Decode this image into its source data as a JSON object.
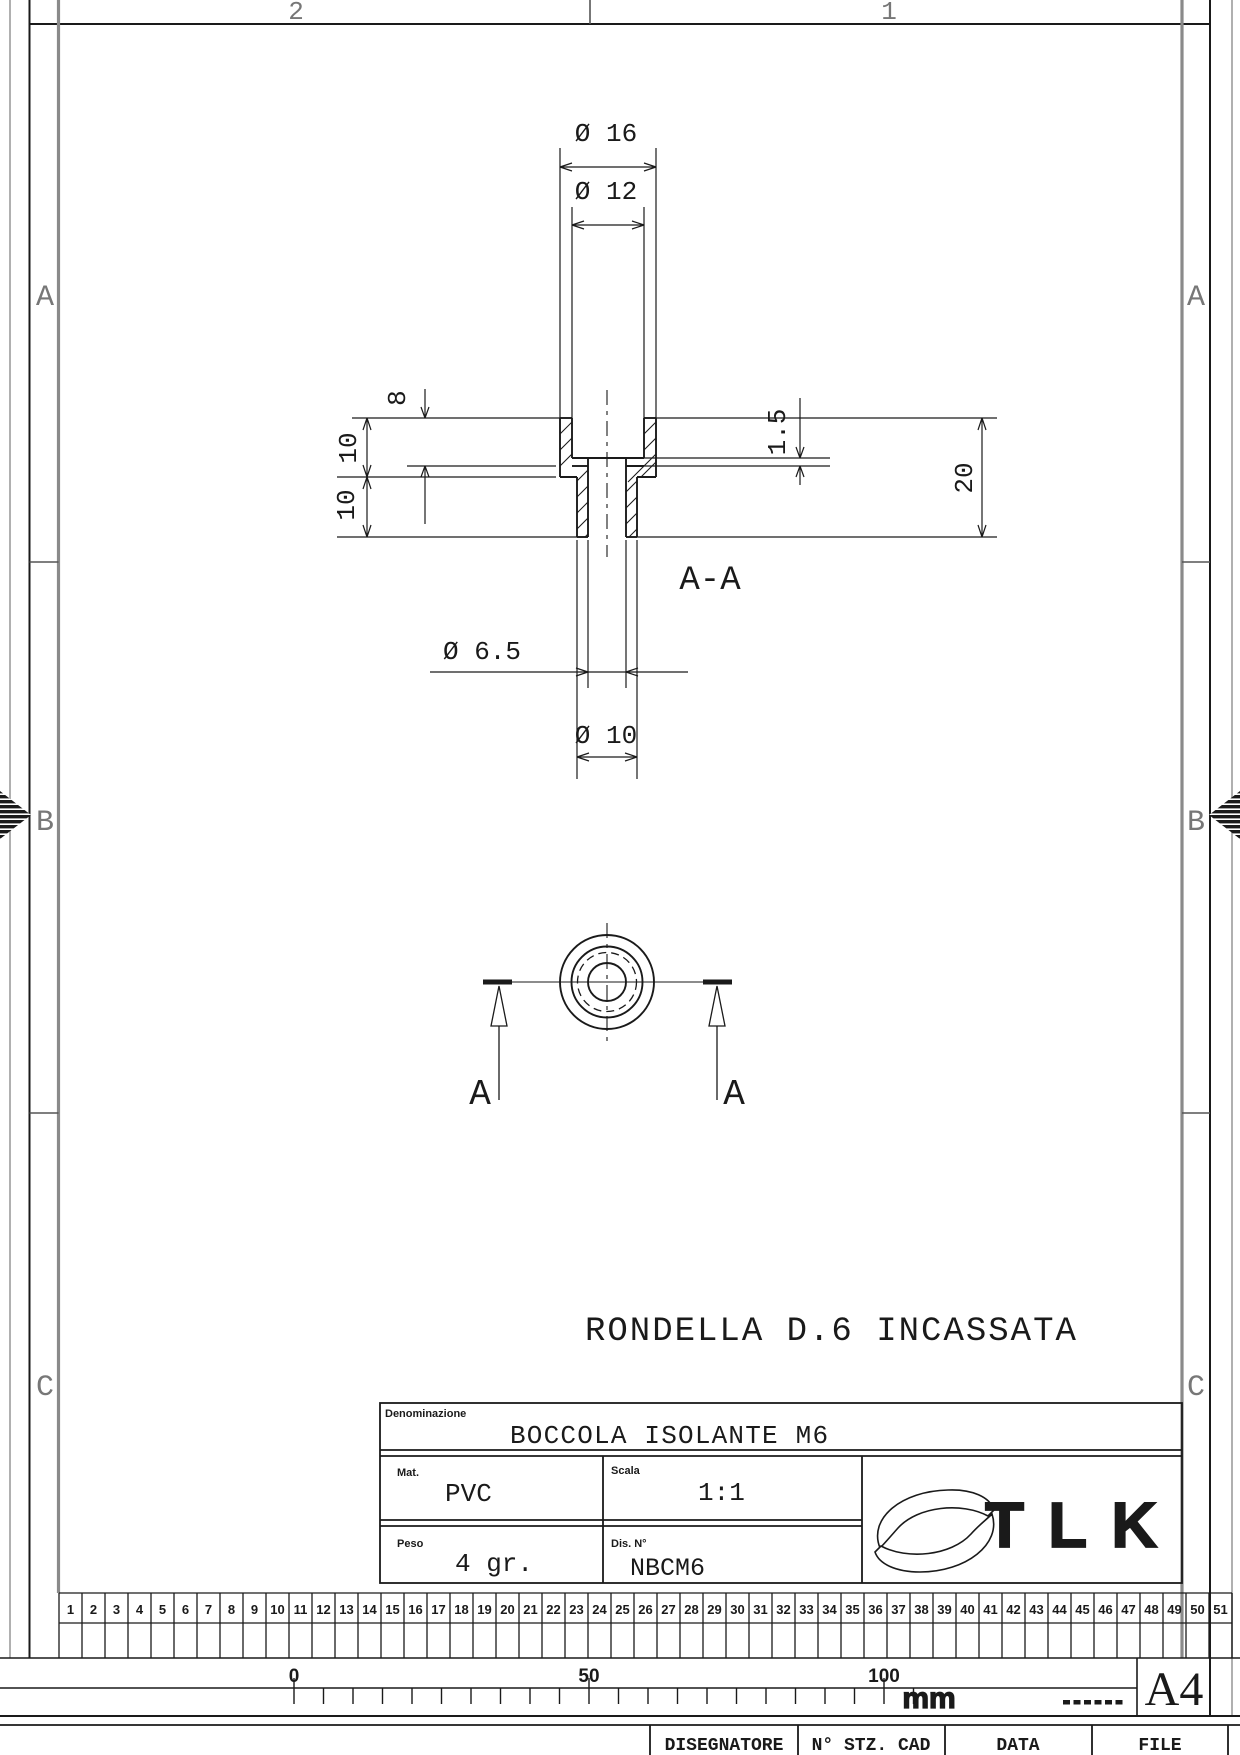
{
  "sheet": {
    "format": "A4",
    "unit": "mm",
    "dots": "......",
    "scale_labels": [
      "0",
      "50",
      "100"
    ]
  },
  "zones": {
    "top": [
      "2",
      "1"
    ],
    "side": [
      "A",
      "B",
      "C"
    ]
  },
  "drawing": {
    "note": "RONDELLA D.6 INCASSATA",
    "section_label": "A-A",
    "cut_arrow_label": "A",
    "dimensions": {
      "outer_flange_dia": "Ø 16",
      "recess_dia": "Ø 12",
      "recess_depth": "8",
      "flange_height": "10",
      "stem_height": "10",
      "washer_thickness": "1.5",
      "total_height": "20",
      "hole_dia": "Ø 6.5",
      "stem_dia": "Ø 10"
    }
  },
  "title_block": {
    "denominazione_label": "Denominazione",
    "denominazione_value": "BOCCOLA ISOLANTE M6",
    "mat_label": "Mat.",
    "mat_value": "PVC",
    "scala_label": "Scala",
    "scala_value": "1:1",
    "peso_label": "Peso",
    "peso_value": "4 gr.",
    "dis_label": "Dis. N°",
    "dis_value": "NBCM6",
    "logo_text": "TLK"
  },
  "ruler_strip": {
    "numbers": [
      "1",
      "2",
      "3",
      "4",
      "5",
      "6",
      "7",
      "8",
      "9",
      "10",
      "11",
      "12",
      "13",
      "14",
      "15",
      "16",
      "17",
      "18",
      "19",
      "20",
      "21",
      "22",
      "23",
      "24",
      "25",
      "26",
      "27",
      "28",
      "29",
      "30",
      "31",
      "32",
      "33",
      "34",
      "35",
      "36",
      "37",
      "38",
      "39",
      "40",
      "41",
      "42",
      "43",
      "44",
      "45",
      "46",
      "47",
      "48",
      "49",
      "50",
      "51"
    ]
  },
  "footer": {
    "cells": [
      "DISEGNATORE",
      "N° STZ. CAD",
      "DATA",
      "FILE"
    ]
  }
}
